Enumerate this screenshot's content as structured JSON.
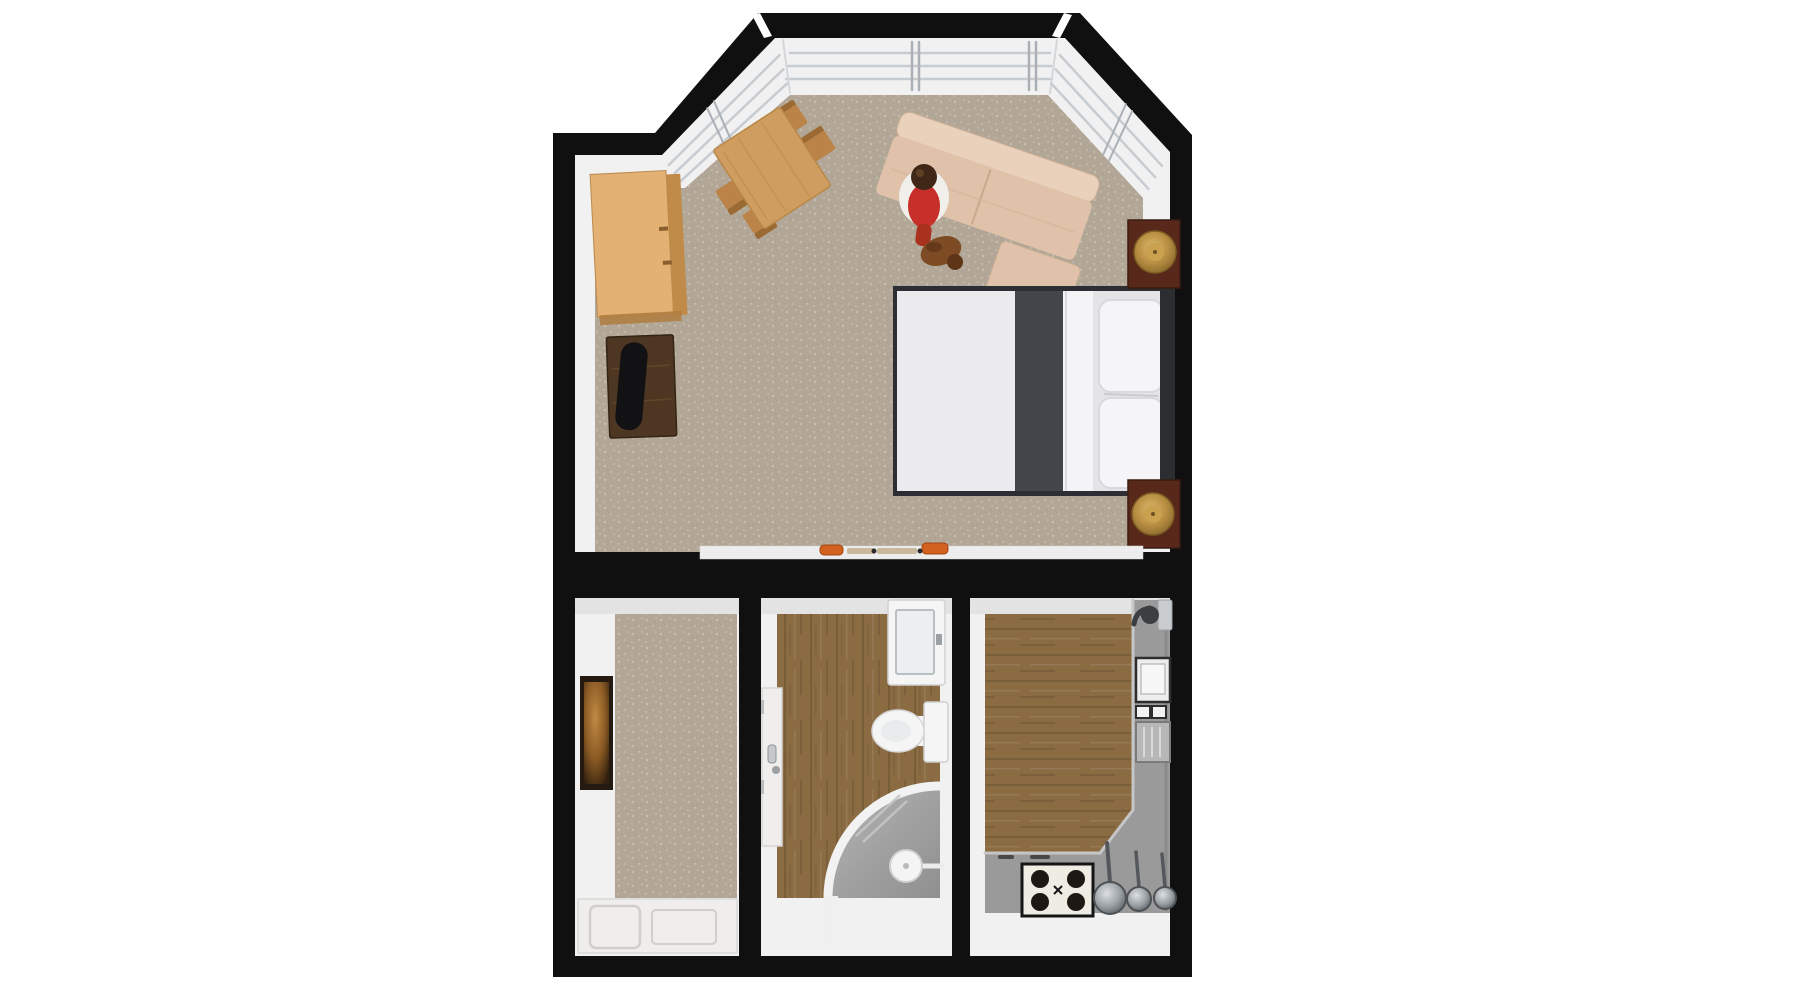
{
  "scene": {
    "type": "3d-floor-plan-top-view",
    "background": "#ffffff",
    "rooms": [
      {
        "name": "living-bedroom",
        "floor": "carpet",
        "features": [
          "bay-window",
          "sofa",
          "double-bed",
          "dining-table",
          "dresser",
          "tv-stand",
          "two-nightstands",
          "person",
          "dog"
        ]
      },
      {
        "name": "entry-hall",
        "floor": "carpet",
        "features": [
          "wall-artwork",
          "front-door-panel"
        ]
      },
      {
        "name": "bathroom",
        "floor": "wood",
        "features": [
          "sink-vanity",
          "toilet",
          "corner-shower",
          "door"
        ]
      },
      {
        "name": "kitchen",
        "floor": "wood",
        "features": [
          "l-shaped-counter",
          "stove",
          "three-pans",
          "faucet",
          "appliance"
        ]
      }
    ],
    "counts": {
      "dining_chairs": 4,
      "stove_burners": 4,
      "pans": 3,
      "pillows": 2,
      "nightstands": 2,
      "lamps": 2
    }
  },
  "colors": {
    "wall": "#101010",
    "wall_face": "#f1f1f1",
    "wall_face_dim": "#e3e3e3",
    "carpet": "#b2a797",
    "wood": "#8a6b42",
    "sill": "#eef0f2",
    "pane_line": "#c7ccd1",
    "counter": "#9a9a9a",
    "counter_edge": "#c6c6c6",
    "sofa": "#dfc2a9",
    "sofa_back": "#e9d1bb",
    "duvet": "#ebebee",
    "bed_band": "#44454b",
    "bed_frame": "#2d2e33",
    "pillow": "#f5f5f7",
    "pillow_zone": "#e4e4e7",
    "headboard": "#2c2d31",
    "nightstand": "#58291a",
    "lamp": "#b98f44",
    "dresser_top": "#e2b173",
    "dresser_side": "#c08a49",
    "tv_stand": "#4e3722",
    "tv": "#121214",
    "table": "#cf9d60",
    "chair": "#bb8348",
    "chair_back": "#9b6a33",
    "hair": "#3f2817",
    "top_red": "#c62f2a",
    "wrap_white": "#f1efe9",
    "legs": "#a9321f",
    "dog": "#7d4b24",
    "art_frame": "#241a12",
    "door": "#efeeec",
    "fixture": "#f5f5f5",
    "tray": "#a2a2a2",
    "chrome": "#c3c6c9",
    "stove": "#efece3",
    "burner": "#1d1813",
    "orange": "#d2601e",
    "tan": "#c9b79e"
  }
}
